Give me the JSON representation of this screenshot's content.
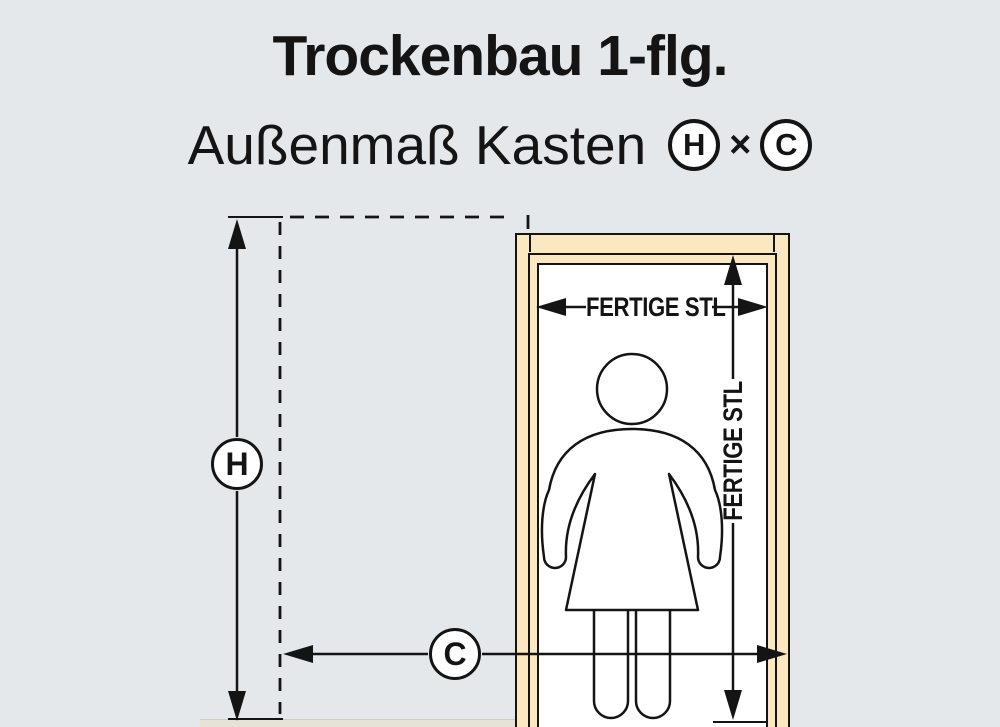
{
  "header": {
    "title": "Trockenbau 1-flg.",
    "subtitle": "Außenmaß Kasten",
    "height_symbol": "H",
    "multiply_symbol": "×",
    "width_symbol": "C"
  },
  "diagram": {
    "height_circle_label": "H",
    "width_circle_label": "C",
    "clear_width_label": "FERTIGE STL",
    "clear_height_label": "FERTIGE STL"
  },
  "colors": {
    "background": "#e4e8eb",
    "frame_wood": "#fbe7c0",
    "line": "#141414",
    "floor_strip": "#e6e2d8",
    "interior": "#ffffff"
  }
}
